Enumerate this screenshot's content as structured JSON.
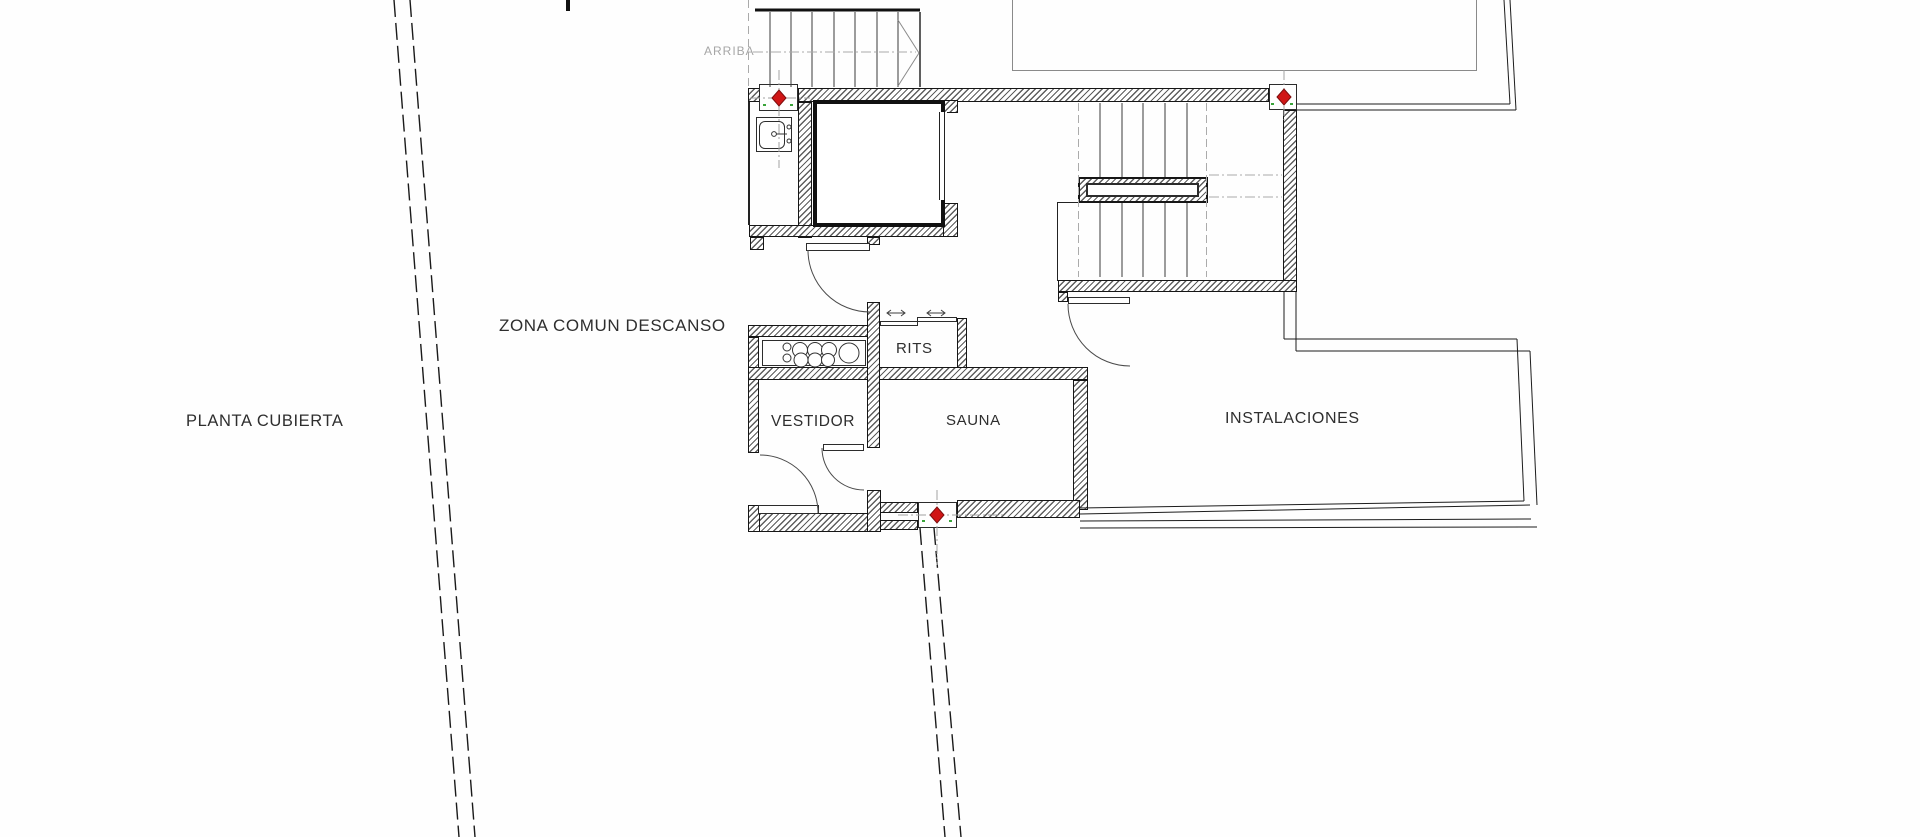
{
  "plan": {
    "floor_label": "PLANTA CUBIERTA",
    "zone_label": "ZONA COMUN DESCANSO",
    "stair_direction_label": "ARRIBA",
    "rooms": {
      "vestidor": "VESTIDOR",
      "sauna": "SAUNA",
      "rits": "RITS",
      "instalaciones": "INSTALACIONES"
    },
    "markers": {
      "count": 3,
      "symbol": "red-diamond-survey-marker"
    },
    "colors": {
      "background": "#fefefe",
      "wall_line": "#161616",
      "hatch_line": "#5e5e5e",
      "marker_red": "#d01616",
      "marker_red_outline": "#7d0f0f",
      "marker_green_tick": "#3aa43a",
      "guide_grey": "#a2a2a2",
      "boundary_line": "#1c1c1c",
      "pool_outline_grey": "#8a8a8a",
      "label_text": "#2e2e2e",
      "muted_label_text": "#a6a6a6"
    }
  }
}
